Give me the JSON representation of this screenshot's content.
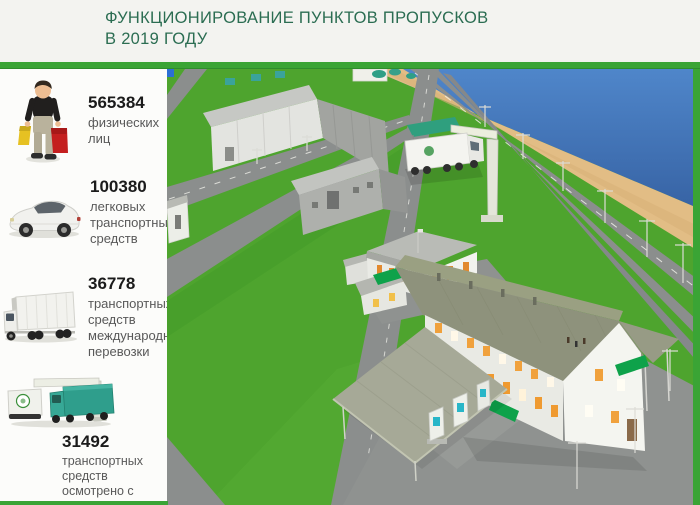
{
  "header": {
    "title_line1": "ФУНКЦИОНИРОВАНИЕ ПУНКТОВ ПРОПУСКОВ",
    "title_line2": "В 2019 ГОДУ"
  },
  "stats": [
    {
      "value": "565384",
      "label": "физических лиц",
      "icon": "person-with-bags-icon"
    },
    {
      "value": "100380",
      "label": "легковых транспортных средств",
      "icon": "passenger-car-icon"
    },
    {
      "value": "36778",
      "label": "транспортных средств международной перевозки",
      "icon": "cargo-truck-icon"
    },
    {
      "value": "31492",
      "label": "транспортных средств осмотрено с использованием МИДК",
      "icon": "midk-scanner-icon"
    }
  ],
  "scene": {
    "name": "checkpoint-aerial-3d-render",
    "features": [
      "water",
      "beach",
      "roads",
      "warehouse-buildings",
      "administrative-building",
      "main-terminal-building",
      "inspection-canopy",
      "midk-scanner-truck",
      "inspection-booths",
      "light-poles"
    ]
  },
  "colors": {
    "accent_green": "#3aa435",
    "title_green": "#2b6d52",
    "number_color": "#1b1b1b",
    "label_color": "#595959",
    "header_bg": "#f3f3f0",
    "panel_bg": "#fcfcfa",
    "grass_green": "#4ea42e",
    "water_blue": "#3f74b8",
    "sand_tan": "#e2bd85",
    "road_gray": "#8b8e8d",
    "roof_olive": "#8e927c",
    "awning_green": "#0ea24a",
    "window_orange": "#f0a13c"
  }
}
